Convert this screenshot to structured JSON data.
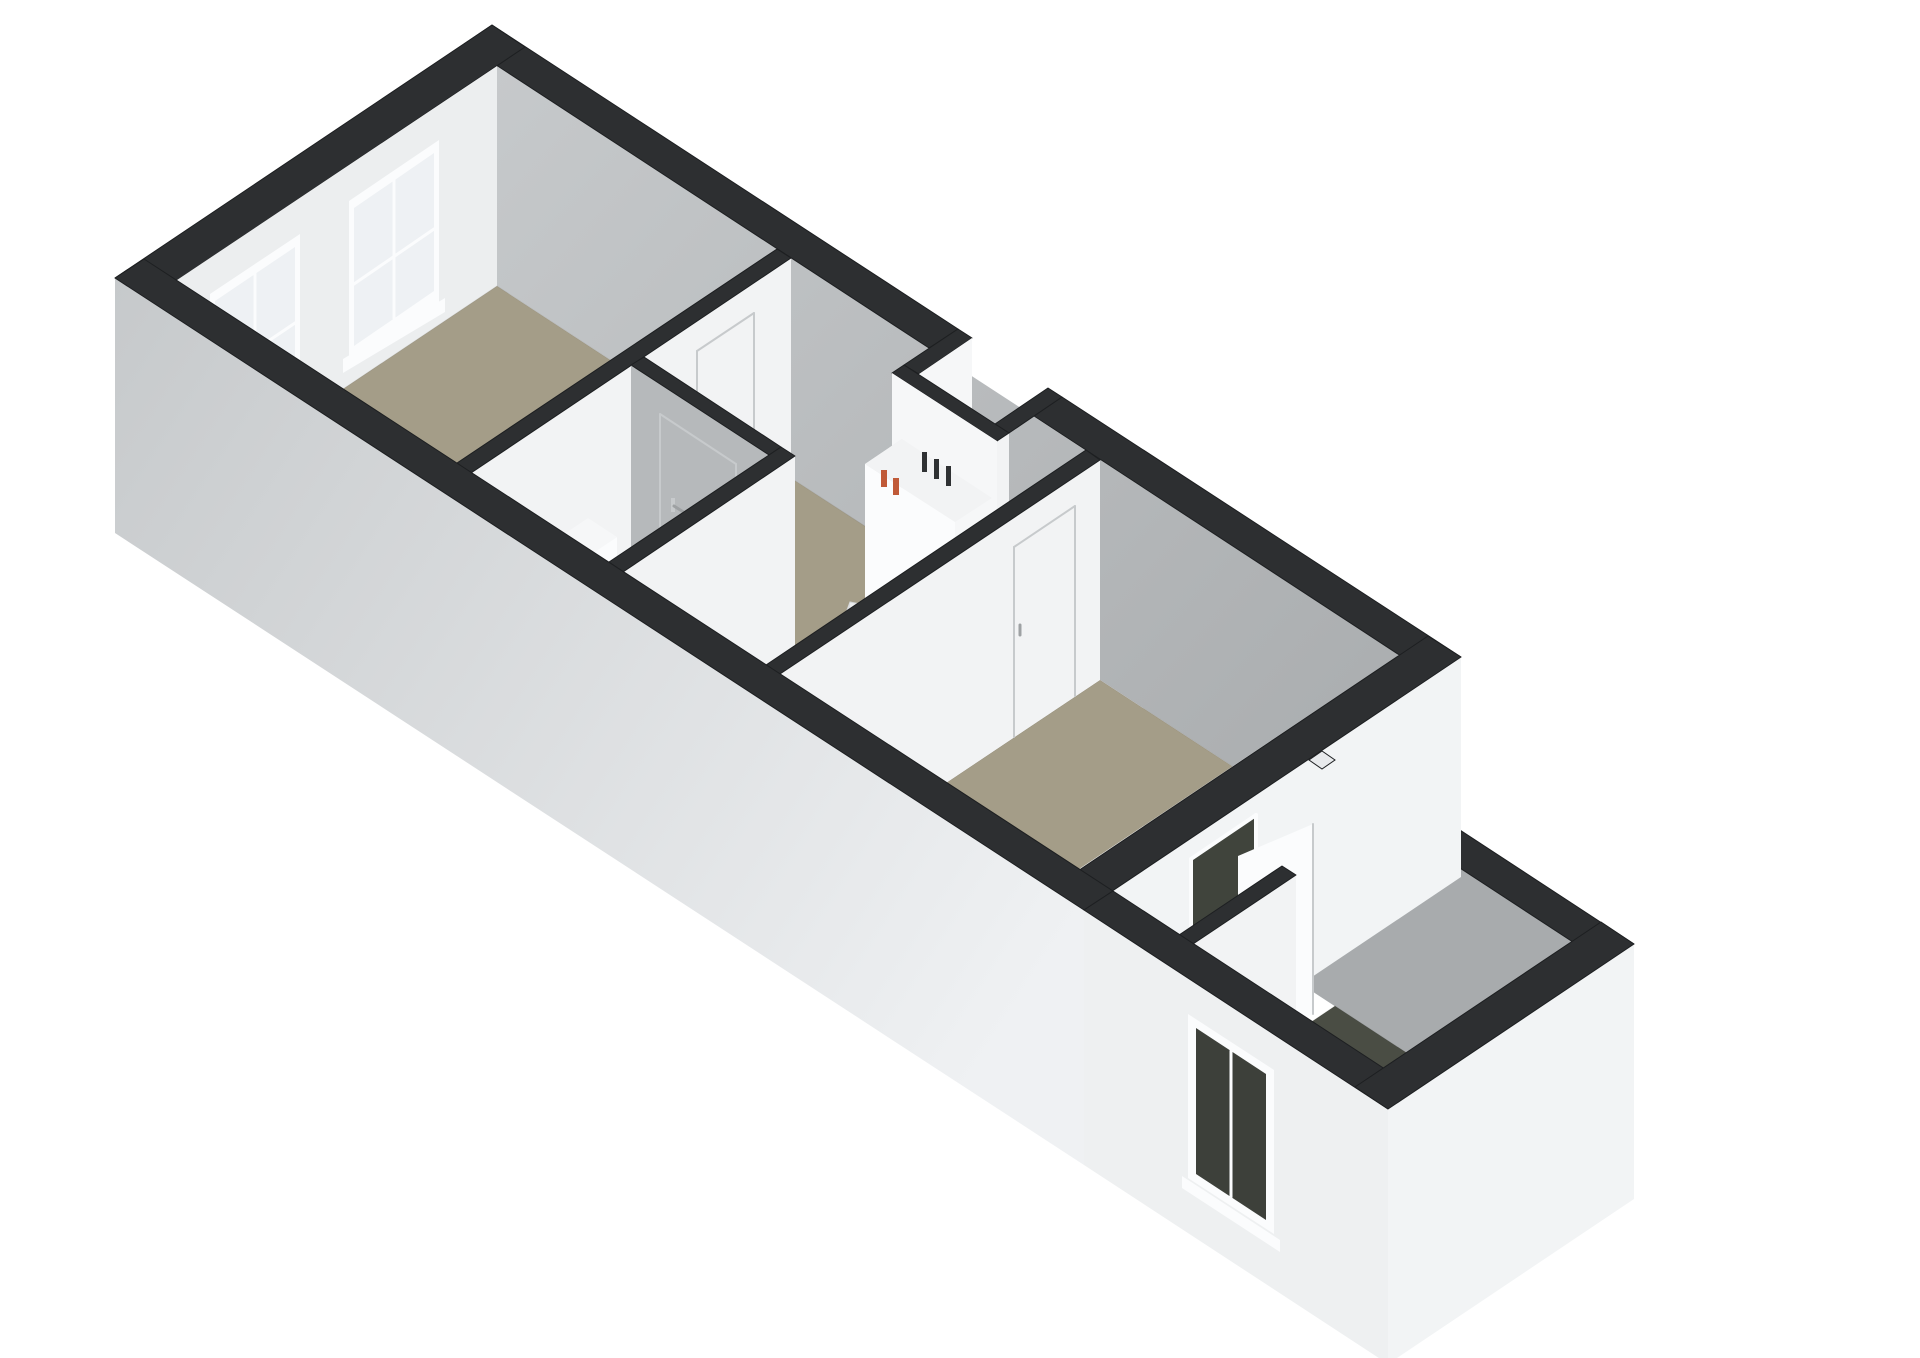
{
  "scene": {
    "type": "3d-floorplan-render",
    "view": "axonometric-from-southwest",
    "background": "#ffffff",
    "building": {
      "main_volume": {
        "rooms": [
          {
            "name": "bedroom",
            "floor": "beige",
            "features": [
              "two sliding windows on north-west end wall"
            ]
          },
          {
            "name": "toilet-room",
            "floor": "sage-grey",
            "fixtures": [
              "toilet with cistern"
            ],
            "doors": [
              "door to hall with handle"
            ]
          },
          {
            "name": "hall",
            "floor": "beige",
            "features": [
              "winder staircase",
              "meter cupboard with pipes",
              "entrance niche"
            ]
          },
          {
            "name": "living-room",
            "floor": "beige",
            "doors": [
              "door to hall with handle"
            ]
          }
        ]
      },
      "annex": {
        "rooms": [
          {
            "name": "annex-room",
            "floor": "dark-olive",
            "features": [
              "window in south-west wall",
              "open door to living room",
              "partition stub",
              "small shaft notch at junction"
            ]
          }
        ]
      }
    }
  },
  "colors": {
    "white": "#ffffff",
    "wallCap": "#2d2f31",
    "extGrayDark": "#bdc0c2",
    "extGrayLeft": "#c6c9cb",
    "extWhiteRight": "#eff1f3",
    "extWhite": "#f2f4f5",
    "annexExtWhite": "#eef0f1",
    "innerGrayLight": "#c6c9cb",
    "innerGrayDeep": "#a8abad",
    "innerGrayMid": "#b6b9bb",
    "innerLight": "#eceeef",
    "innerWhite": "#f2f3f4",
    "faceWhite": "#f6f7f8",
    "stripWhite": "#f0f1f2",
    "floorBeige": "#a49d88",
    "floorToilet": "#9da19a",
    "floorAnnex": "#4a4d44",
    "floorNiche": "#45473f",
    "glassLight": "#eef1f4",
    "glassDark": "#3d403a",
    "frameWhite": "#fbfcfd",
    "doorSeam": "#c7cacc",
    "handleGray": "#9ea1a3",
    "doorwayDark": "#40443c",
    "doorwaySliver": "#575b4e",
    "treadWhite": "#f4f5f6",
    "treadAlt": "#ecedee",
    "treadEdge": "#dcdee0",
    "treadStroke": "#d2d4d6",
    "toiletWhite": "#f6f7f8",
    "toiletFront": "#fbfcfd",
    "toiletSide": "#e6e8ea",
    "toiletBase": "#e3e5e7",
    "pipeOrange": "#c05a38",
    "pipeBlack": "#2f3133",
    "notchLight": "#e8eaec"
  }
}
